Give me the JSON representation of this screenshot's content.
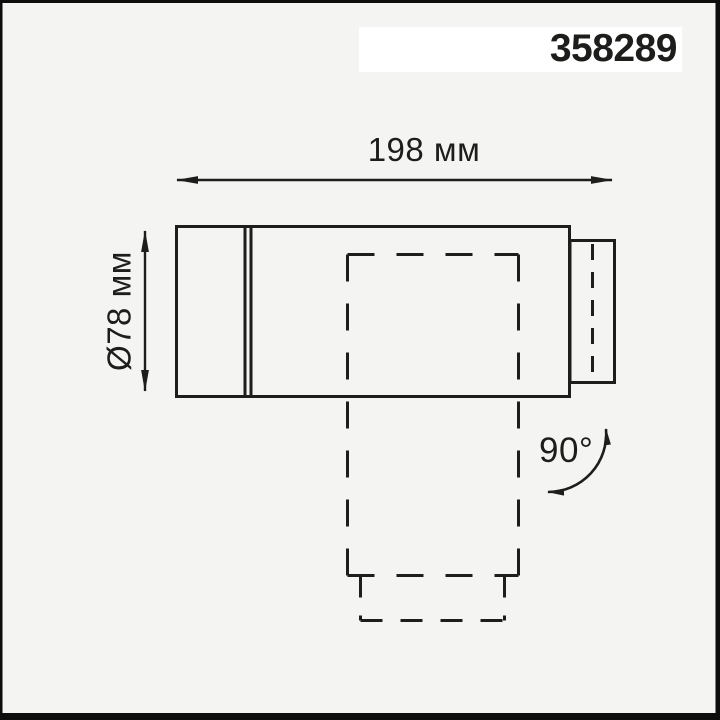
{
  "product_code": "358289",
  "labels": {
    "width": "198 мм",
    "diameter": "Ø78 мм",
    "rotation": "90°"
  },
  "colors": {
    "background": "#f4f4f2",
    "line": "#1d1d1b",
    "frame": "#0d0d0d",
    "label_band": "#ffffff"
  }
}
